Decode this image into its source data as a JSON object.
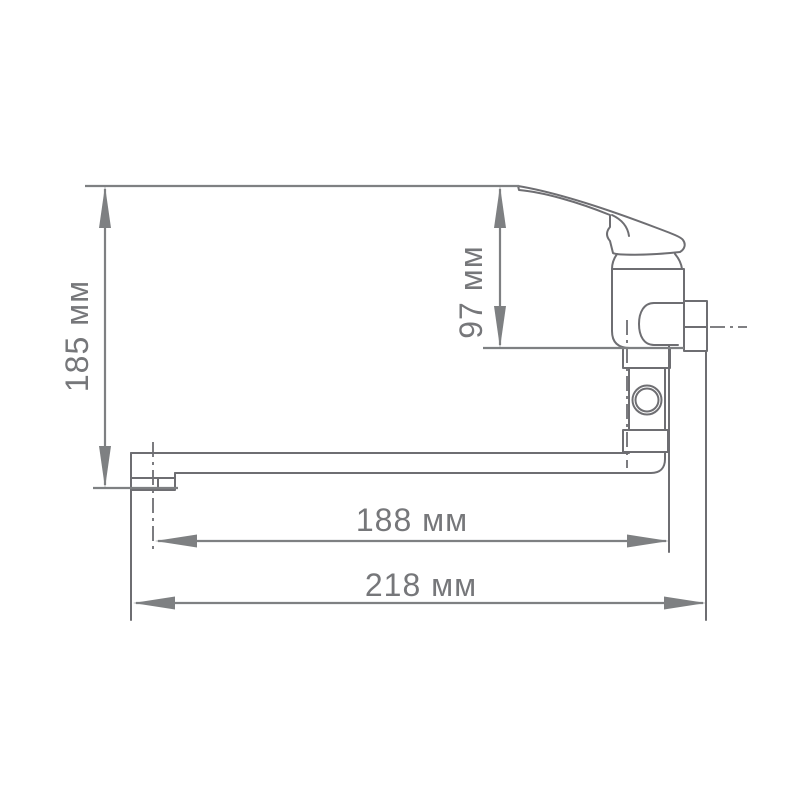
{
  "drawing": {
    "subject": "single-lever wall-mounted faucet with long spout, side view dimensional drawing",
    "background_color": "#ffffff",
    "outline_color": "#6e6e72",
    "dimension_color": "#7e8082",
    "label_color": "#76777a",
    "dimensions": {
      "overall_height": {
        "label": "185 мм",
        "value": 185,
        "unit": "мм",
        "orientation": "vertical"
      },
      "handle_height": {
        "label": "97 мм",
        "value": 97,
        "unit": "мм",
        "orientation": "vertical"
      },
      "spout_reach": {
        "label": "188 мм",
        "value": 188,
        "unit": "мм",
        "orientation": "horizontal"
      },
      "overall_length": {
        "label": "218 мм",
        "value": 218,
        "unit": "мм",
        "orientation": "horizontal"
      }
    }
  }
}
